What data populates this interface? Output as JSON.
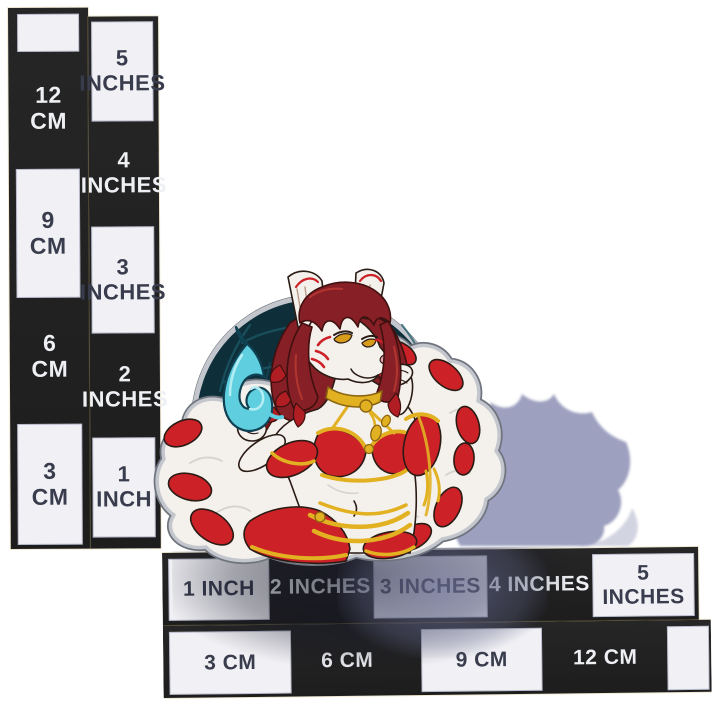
{
  "scene": {
    "type": "product-photo",
    "description": "Hard enamel pin of a flirtatious white kitsune fox woman with dark red hair, yellow eyes, red facial markings, a gold choker with tassels, a red-and-gold bikini outfit and many white red-tipped tails, holding a swirling blue flame in front of a dark navy circle. The pin stands upright on a white background beside two black measurement rulers marked in inches and centimeters, casting a blue-grey shadow to the right."
  },
  "rulers": {
    "vertical": {
      "cm": [
        {
          "text": "",
          "on": "white"
        },
        {
          "text": "12\nCM",
          "on": "black"
        },
        {
          "text": "9\nCM",
          "on": "white"
        },
        {
          "text": "6\nCM",
          "on": "black"
        },
        {
          "text": "3\nCM",
          "on": "white"
        }
      ],
      "inches": [
        {
          "text": "5\nINCHES",
          "on": "white"
        },
        {
          "text": "4\nINCHES",
          "on": "black"
        },
        {
          "text": "3\nINCHES",
          "on": "white"
        },
        {
          "text": "2\nINCHES",
          "on": "black"
        },
        {
          "text": "1\nINCH",
          "on": "white"
        }
      ]
    },
    "horizontal": {
      "inches": [
        {
          "text": "1 INCH",
          "on": "white"
        },
        {
          "text": "2 INCHES",
          "on": "black"
        },
        {
          "text": "3 INCHES",
          "on": "white"
        },
        {
          "text": "4 INCHES",
          "on": "black"
        },
        {
          "text": "5 INCHES",
          "on": "white"
        }
      ],
      "cm": [
        {
          "text": "3 CM",
          "on": "white"
        },
        {
          "text": "6 CM",
          "on": "black"
        },
        {
          "text": "9 CM",
          "on": "white"
        },
        {
          "text": "12 CM",
          "on": "black"
        },
        {
          "text": "",
          "on": "white"
        }
      ]
    }
  },
  "colors": {
    "bg": "#ffffff",
    "ruler_black": "#262626",
    "ruler_box_white": "#f1f1f5",
    "ruler_text_dark": "#383c4c",
    "ruler_text_light": "#eef0f4",
    "pin_white": "#f4f1ec",
    "pin_outline": "#2a1b14",
    "metal_silver": "#c3c6cc",
    "metal_dark": "#70747e",
    "hair_maroon": "#872026",
    "hair_highlight": "#b23530",
    "accent_red": "#cd2128",
    "claw_red": "#7a1216",
    "gold": "#e2b122",
    "gold_dark": "#8a6410",
    "flame_cyan": "#5fcfe0",
    "flame_cyan_light": "#b5edf4",
    "flame_outline": "#0f4152",
    "backdrop_navy": "#0e2f3a",
    "backdrop_streak": "#1d5a68",
    "eye_amber": "#d89c1c",
    "nose_pink": "#e9aab4",
    "shadow_lavender": "#9296b8",
    "fur_shade": "#d6d3cd"
  }
}
